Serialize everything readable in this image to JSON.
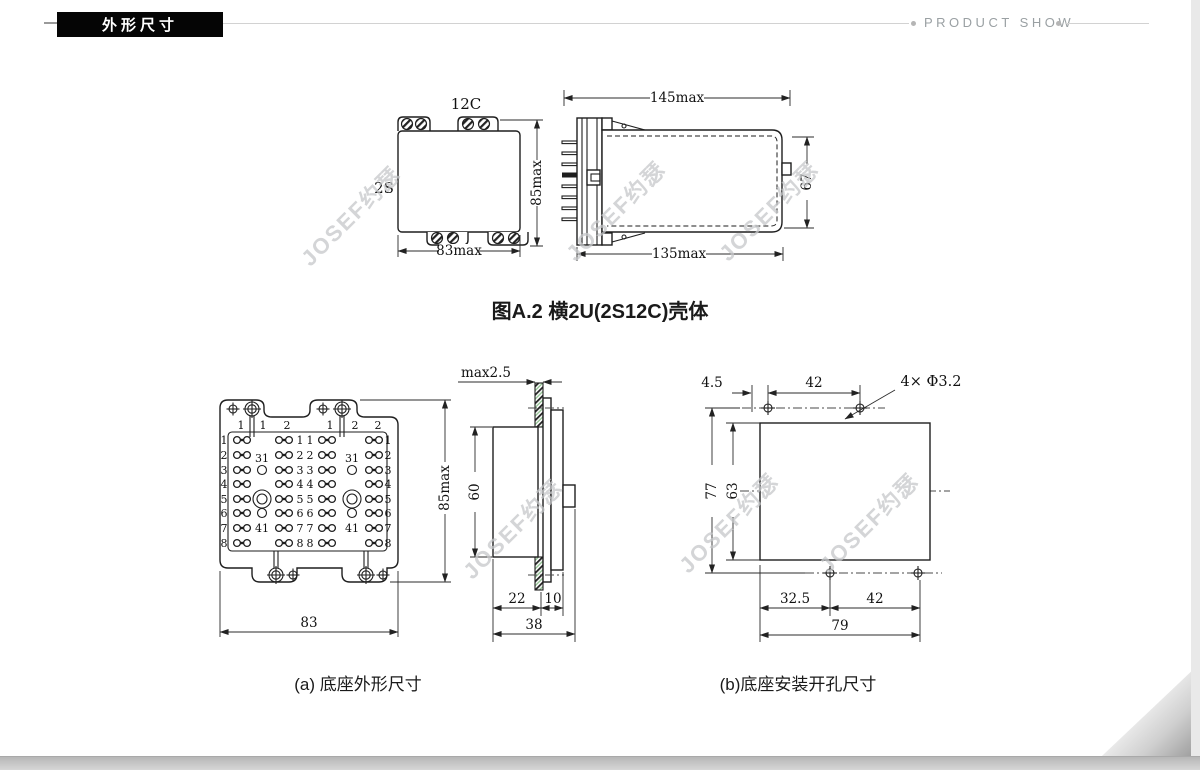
{
  "header": {
    "tag": "外形尺寸",
    "right_label": "PRODUCT SHOW"
  },
  "watermark": "JOSEF约瑟",
  "figure_a2": {
    "caption": "图A.2  横2U(2S12C)壳体",
    "front": {
      "code_top": "12C",
      "code_left": "2S",
      "width": "83max",
      "height": "85max"
    },
    "side": {
      "length_top": "145max",
      "length_bottom": "135max",
      "height": "67"
    }
  },
  "base_outline": {
    "caption": "(a) 底座外形尺寸",
    "width": "83",
    "height": "85max",
    "headers_left": [
      "1",
      "1",
      "2"
    ],
    "headers_right": [
      "1",
      "2",
      "2"
    ],
    "rows": [
      "1",
      "2",
      "3",
      "4",
      "5",
      "6",
      "7",
      "8"
    ],
    "post_upper": "31",
    "post_lower": "41",
    "side": {
      "panel": "max2.5",
      "height": "60",
      "front_depth": "22",
      "rear_depth": "10",
      "total_depth": "38"
    }
  },
  "base_mounting": {
    "caption": "(b)底座安装开孔尺寸",
    "edge_offset": "4.5",
    "top_spacing": "42",
    "holes": "4× Φ3.2",
    "outer_height": "77",
    "inner_height": "63",
    "bottom_left": "32.5",
    "bottom_spacing": "42",
    "total_width": "79"
  },
  "colors": {
    "accent_black": "#050505",
    "line": "#1e1e1e",
    "watermark": "#c6c8ca",
    "muted": "#9aa0a3"
  }
}
